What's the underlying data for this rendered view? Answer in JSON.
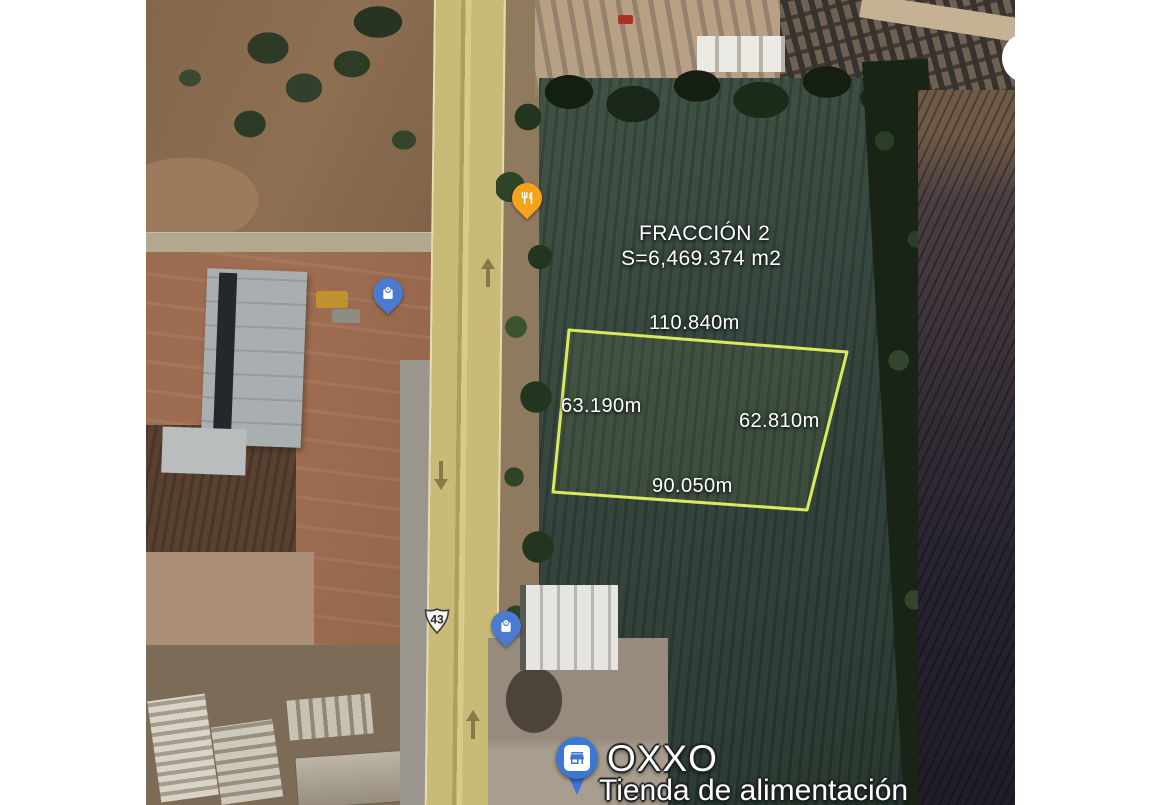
{
  "map": {
    "parcel": {
      "title": "FRACCIÓN 2",
      "area": "S=6,469.374 m2",
      "side_top": "110.840m",
      "side_left": "63.190m",
      "side_right": "62.810m",
      "side_bottom": "90.050m",
      "outline_color": "#D9EA5E"
    },
    "highway_shield": "43",
    "poi": {
      "oxxo_name": "OXXO",
      "oxxo_category": "Tienda de alimentación"
    },
    "pins": [
      {
        "id": "restaurant",
        "icon": "restaurant-icon",
        "color": "#F5A31C"
      },
      {
        "id": "shopping-north",
        "icon": "shopping-bag-icon",
        "color": "#4A7BD0"
      },
      {
        "id": "shopping-south",
        "icon": "shopping-bag-icon",
        "color": "#4A7BD0"
      },
      {
        "id": "oxxo-store",
        "icon": "storefront-icon",
        "color": "#3B77D3"
      }
    ]
  }
}
